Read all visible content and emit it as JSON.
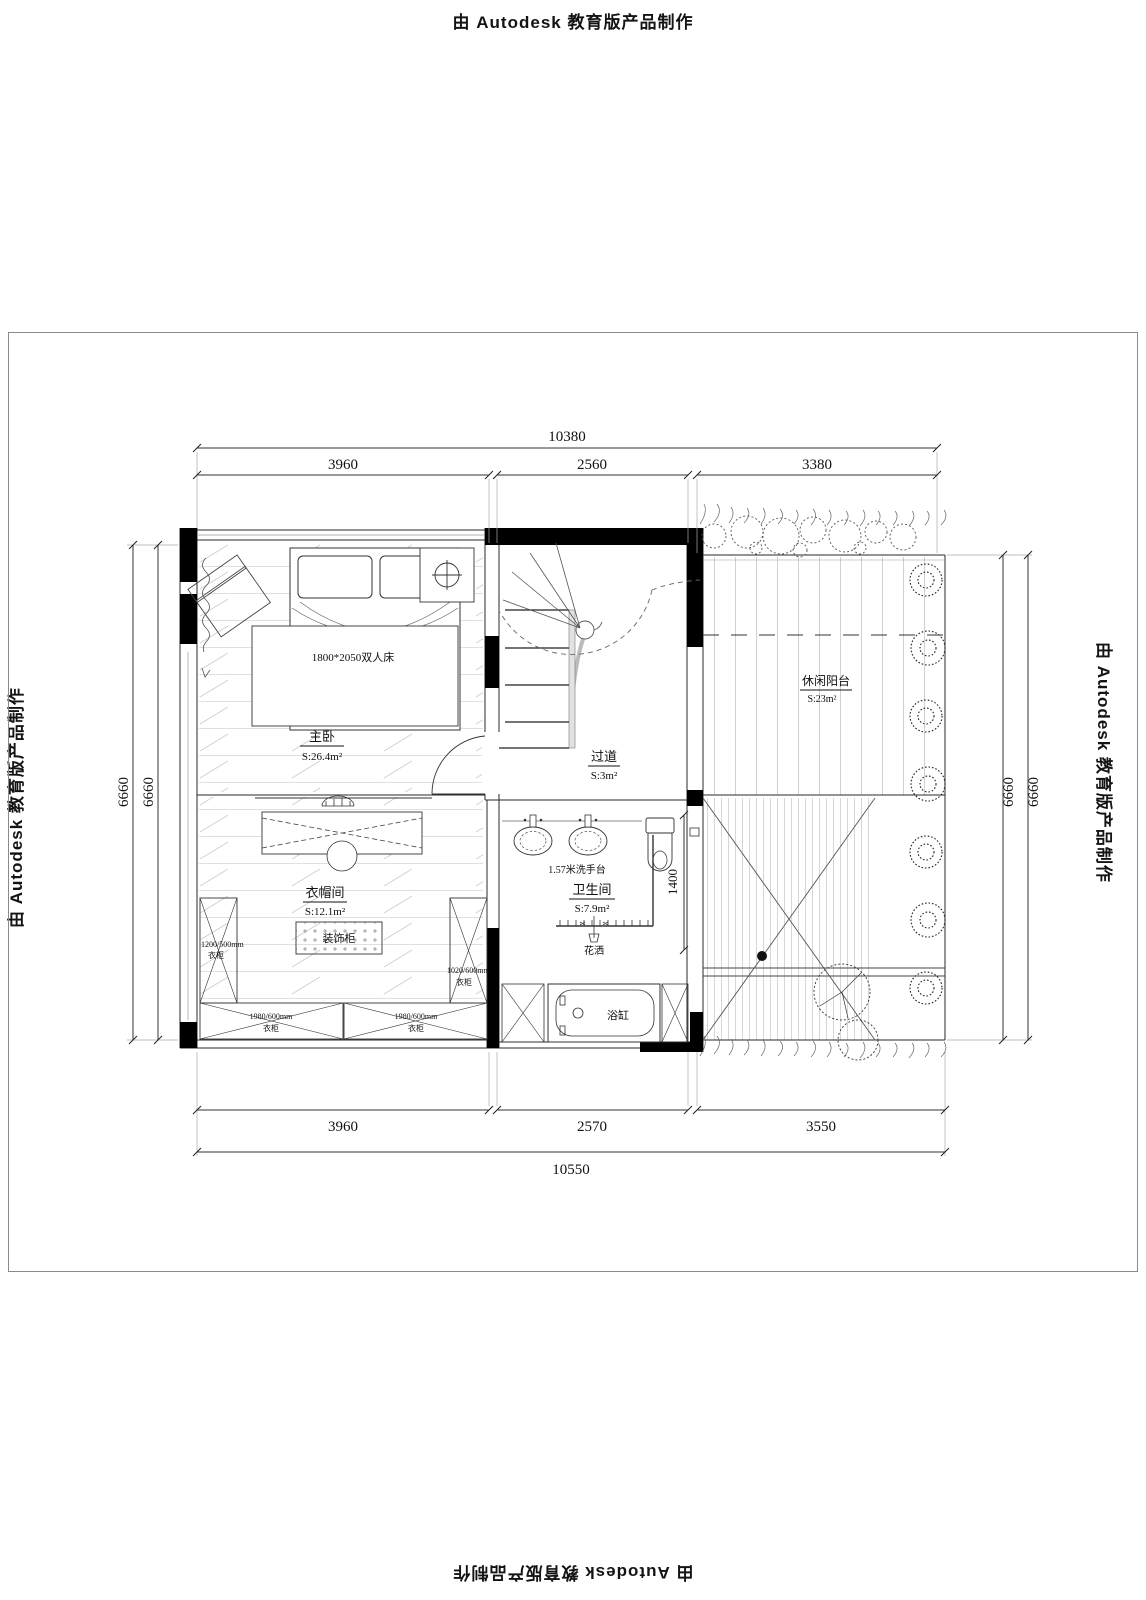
{
  "watermark": "由 Autodesk 教育版产品制作",
  "dims": {
    "top_total": "10380",
    "top": [
      "3960",
      "2560",
      "3380"
    ],
    "bottom": [
      "3960",
      "2570",
      "3550"
    ],
    "bottom_total": "10550",
    "left": [
      "6660",
      "6660"
    ],
    "right": [
      "6660",
      "6660"
    ],
    "toilet": "1400"
  },
  "rooms": {
    "master": {
      "name": "主卧",
      "area": "S:26.4m²"
    },
    "hallway": {
      "name": "过道",
      "area": "S:3m²"
    },
    "closet": {
      "name": "衣帽间",
      "area": "S:12.1m²"
    },
    "bathroom": {
      "name": "卫生间",
      "area": "S:7.9m²"
    },
    "balcony": {
      "name": "休闲阳台",
      "area": "S:23m²"
    }
  },
  "furniture": {
    "bed": "1800*2050双人床",
    "vanity": "1.57米洗手台",
    "shower": "花洒",
    "bathtub": "浴缸",
    "decor_cabinet": "装饰柜",
    "wardrobes": [
      {
        "size": "1200/500mm",
        "label": "衣柜"
      },
      {
        "size": "1020/600mm",
        "label": "衣柜"
      },
      {
        "size": "1980/600mm",
        "label": "衣柜"
      },
      {
        "size": "1980/600mm",
        "label": "衣柜"
      }
    ]
  }
}
